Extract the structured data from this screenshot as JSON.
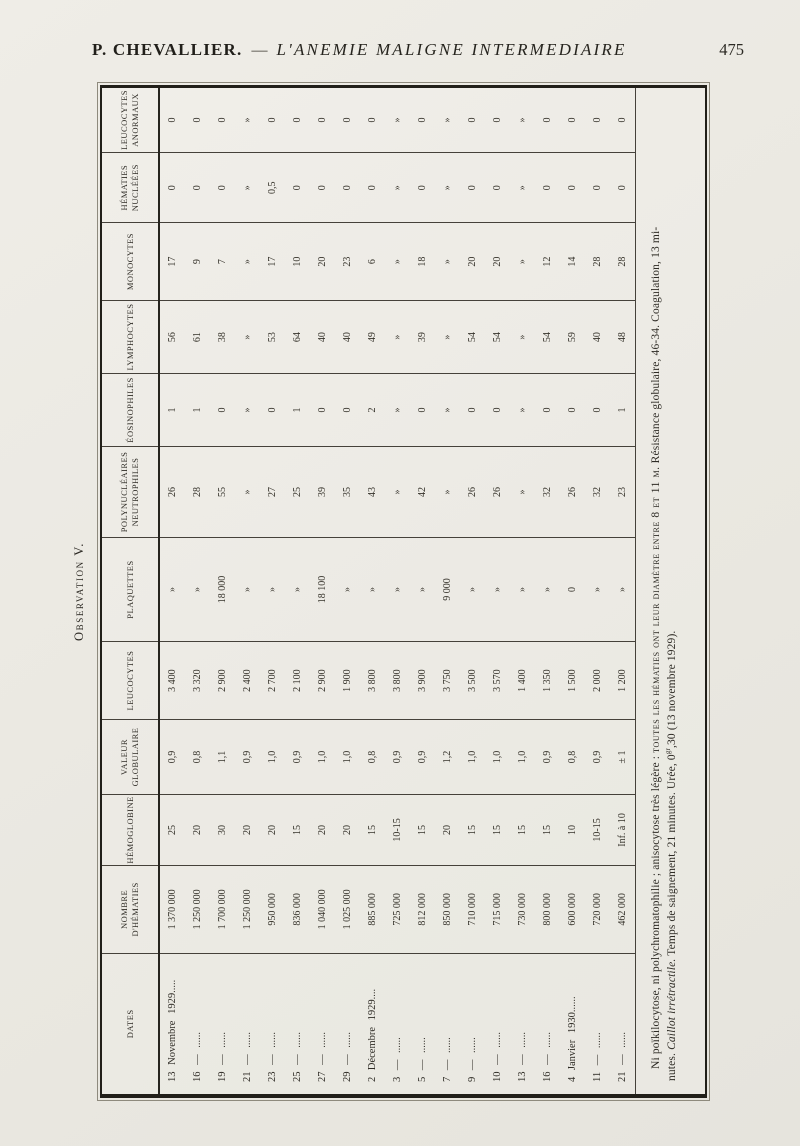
{
  "page_header": {
    "author": "P. CHEVALLIER.",
    "dash": "—",
    "title": "L'ANEMIE MALIGNE INTERMEDIAIRE",
    "page_number": "475"
  },
  "observation_title": "Observation V.",
  "table": {
    "headers": [
      "DATES",
      "NOMBRE\nD'HÉMATIES",
      "HÉMOGLOBINE",
      "VALEUR\nGLOBULAIRE",
      "LEUCOCYTES",
      "PLAQUETTES",
      "POLYNUCLÉAIRES\nNEUTROPHILES",
      "ÉOSINOPHILES",
      "LYMPHOCYTES",
      "MONOCYTES",
      "HÉMATIES\nNUCLÉÉES",
      "LEUCOCYTES\nANORMAUX"
    ],
    "rows": [
      {
        "date": "13 Novembre 1929.....",
        "values": [
          "1 370 000",
          "25",
          "0,9",
          "3 400",
          "»",
          "26",
          "1",
          "56",
          "17",
          "0",
          "0"
        ]
      },
      {
        "date": "16 — ......",
        "values": [
          "1 250 000",
          "20",
          "0,8",
          "3 320",
          "»",
          "28",
          "1",
          "61",
          "9",
          "0",
          "0"
        ]
      },
      {
        "date": "19 — ......",
        "values": [
          "1 700 000",
          "30",
          "1,1",
          "2 900",
          "18 000",
          "55",
          "0",
          "38",
          "7",
          "0",
          "0"
        ]
      },
      {
        "date": "21 — ......",
        "values": [
          "1 250 000",
          "20",
          "0,9",
          "2 400",
          "»",
          "»",
          "»",
          "»",
          "»",
          "»",
          "»"
        ]
      },
      {
        "date": "23 — ......",
        "values": [
          "950 000",
          "20",
          "1,0",
          "2 700",
          "»",
          "27",
          "0",
          "53",
          "17",
          "0,5",
          "0"
        ]
      },
      {
        "date": "25 — ......",
        "values": [
          "836 000",
          "15",
          "0,9",
          "2 100",
          "»",
          "25",
          "1",
          "64",
          "10",
          "0",
          "0"
        ]
      },
      {
        "date": "27 — ......",
        "values": [
          "1 040 000",
          "20",
          "1,0",
          "2 900",
          "18 100",
          "39",
          "0",
          "40",
          "20",
          "0",
          "0"
        ]
      },
      {
        "date": "29 — ......",
        "values": [
          "1 025 000",
          "20",
          "1,0",
          "1 900",
          "»",
          "35",
          "0",
          "40",
          "23",
          "0",
          "0"
        ]
      },
      {
        "date": "2 Décembre 1929....",
        "values": [
          "885 000",
          "15",
          "0,8",
          "3 800",
          "»",
          "43",
          "2",
          "49",
          "6",
          "0",
          "0"
        ]
      },
      {
        "date": "3 — ......",
        "values": [
          "725 000",
          "10-15",
          "0,9",
          "3 800",
          "»",
          "»",
          "»",
          "»",
          "»",
          "»",
          "»"
        ]
      },
      {
        "date": "5 — ......",
        "values": [
          "812 000",
          "15",
          "0,9",
          "3 900",
          "»",
          "42",
          "0",
          "39",
          "18",
          "0",
          "0"
        ]
      },
      {
        "date": "7 — ......",
        "values": [
          "850 000",
          "20",
          "1,2",
          "3 750",
          "9 000",
          "»",
          "»",
          "»",
          "»",
          "»",
          "»"
        ]
      },
      {
        "date": "9 — ......",
        "values": [
          "710 000",
          "15",
          "1,0",
          "3 500",
          "»",
          "26",
          "0",
          "54",
          "20",
          "0",
          "0"
        ]
      },
      {
        "date": "10 — ......",
        "values": [
          "715 000",
          "15",
          "1,0",
          "3 570",
          "»",
          "26",
          "0",
          "54",
          "20",
          "0",
          "0"
        ]
      },
      {
        "date": "13 — ......",
        "values": [
          "730 000",
          "15",
          "1,0",
          "1 400",
          "»",
          "»",
          "»",
          "»",
          "»",
          "»",
          "»"
        ]
      },
      {
        "date": "16 — ......",
        "values": [
          "800 000",
          "15",
          "0,9",
          "1 350",
          "»",
          "32",
          "0",
          "54",
          "12",
          "0",
          "0"
        ]
      },
      {
        "date": "4 Janvier 1930......",
        "values": [
          "600 000",
          "10",
          "0,8",
          "1 500",
          "0",
          "26",
          "0",
          "59",
          "14",
          "0",
          "0"
        ]
      },
      {
        "date": "11 — ......",
        "values": [
          "720 000",
          "10-15",
          "0,9",
          "2 000",
          "»",
          "32",
          "0",
          "40",
          "28",
          "0",
          "0"
        ]
      },
      {
        "date": "21 — ......",
        "values": [
          "462 000",
          "Inf. à 10",
          "± 1",
          "1 200",
          "»",
          "23",
          "1",
          "48",
          "28",
          "0",
          "0"
        ]
      }
    ]
  },
  "footnote": {
    "line1_text": "Ni poïkilocytose, ni polychromatophilie ; anisocytose très légère : ",
    "line1_smallcaps": "toutes les hématies ont leur diamètre entre 8 et 11 μ.",
    "line1_end": " Résistance globulaire, 46-34. Coagulation, 13 mi-",
    "line2_start": "nutes. ",
    "line2_italic": "Caillot irrétractile.",
    "line2_mid": " Temps de saignement, 21 minutes. Urée, 0",
    "line2_sup": "gr",
    "line2_end": ",30 (13 novembre 1929)."
  }
}
